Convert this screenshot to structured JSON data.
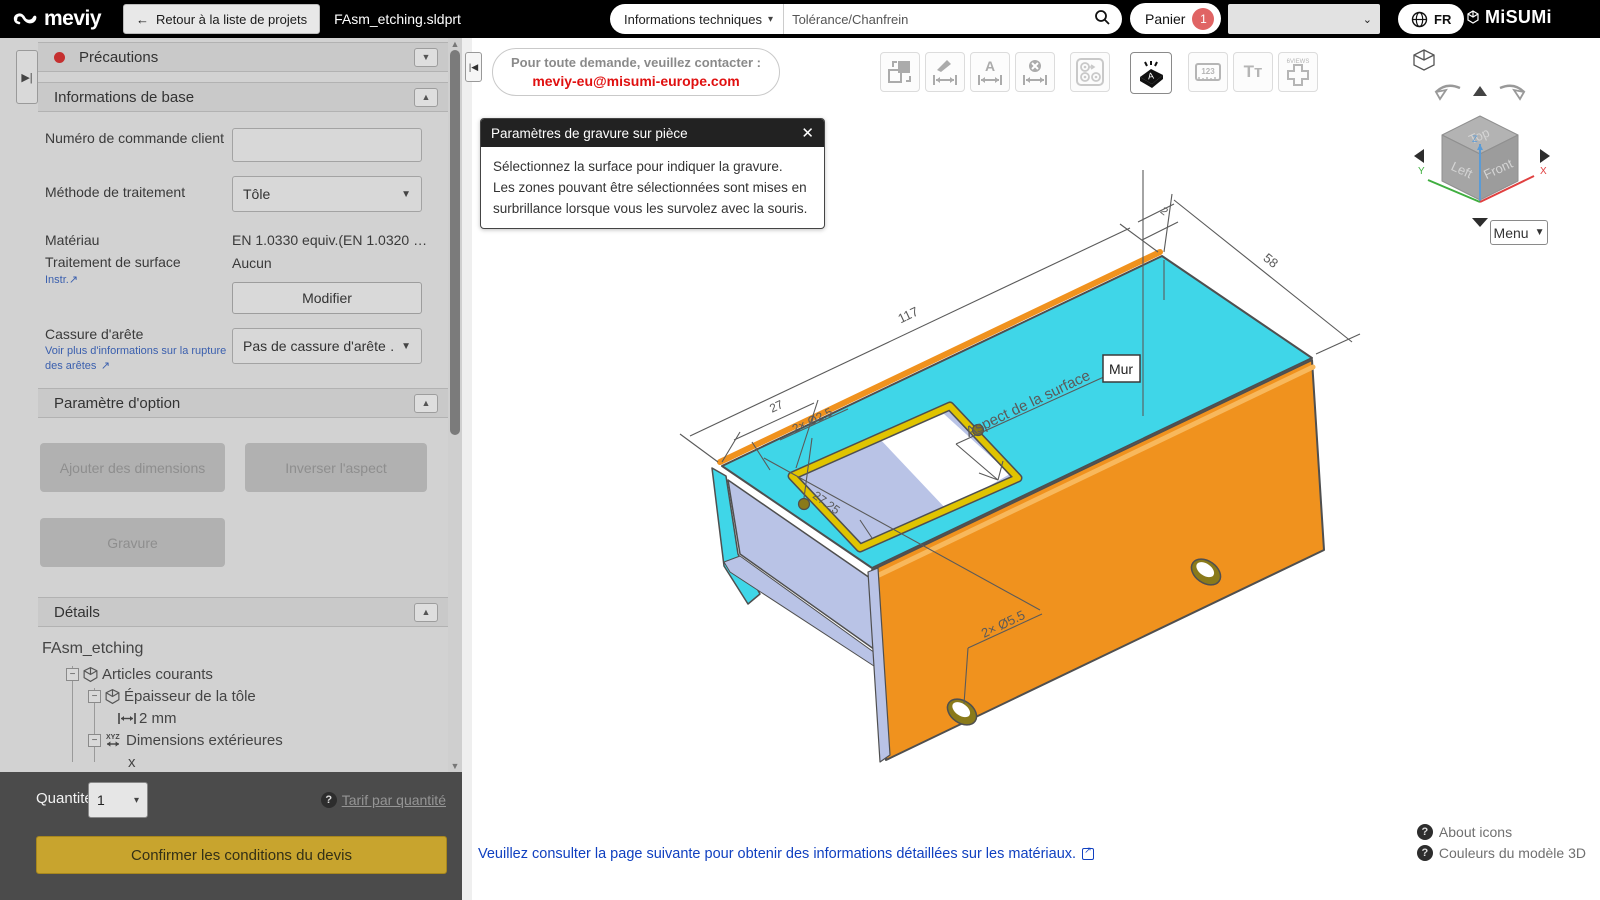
{
  "topbar": {
    "logo": "meviy",
    "back_button": "Retour à la liste de projets",
    "file_title": "FAsm_etching.sldprt",
    "info_dropdown": "Informations techniques",
    "search_value": "Tolérance/Chanfrein",
    "cart_label": "Panier",
    "cart_count": "1",
    "lang": "FR",
    "brand": "MiSUMi"
  },
  "sidebar": {
    "precautions_title": "Précautions",
    "basic_info": {
      "title": "Informations de base",
      "order_number_label": "Numéro de commande client",
      "treatment_method_label": "Méthode de traitement",
      "treatment_method_value": "Tôle",
      "material_label": "Matériau",
      "material_value": "EN 1.0330 equiv.(EN 1.0320 …",
      "surface_label": "Traitement de surface",
      "surface_value": "Aucun",
      "instr_link": "Instr.",
      "modify_button": "Modifier",
      "edge_break_label": "Cassure d'arête",
      "edge_break_link": "Voir plus d'informations sur la rupture des arêtes",
      "edge_break_value": "Pas de cassure d'arête …"
    },
    "option_params": {
      "title": "Paramètre d'option",
      "add_dimensions": "Ajouter des dimensions",
      "invert_aspect": "Inverser l'aspect",
      "engraving": "Gravure"
    },
    "details": {
      "title": "Détails",
      "root": "FAsm_etching",
      "items": [
        {
          "label": "Articles courants",
          "icon": "cube-icon"
        },
        {
          "label": "Épaisseur de la tôle",
          "icon": "cube-icon"
        },
        {
          "label": "2 mm",
          "icon": "width-dimension-icon"
        },
        {
          "label": "Dimensions extérieures",
          "icon": "xyz-dimension-icon"
        },
        {
          "label": "x",
          "icon": "none"
        }
      ]
    },
    "footer": {
      "quantity_label": "Quantité",
      "quantity_value": "1",
      "tariff_link": "Tarif par quantité",
      "confirm_button": "Confirmer les conditions du devis"
    }
  },
  "main": {
    "contact": {
      "line1": "Pour toute demande, veuillez contacter :",
      "email": "meviy-eu@misumi-europe.com"
    },
    "dialog": {
      "title": "Paramètres de gravure sur pièce",
      "body": [
        "Sélectionnez la surface pour indiquer la gravure.",
        "Les zones pouvant être sélectionnées sont mises en",
        "surbrillance lorsque vous les survolez avec la souris."
      ]
    },
    "toolbar": {
      "six_views_label": "6VIEWS",
      "ruler_label": "123",
      "text_label": "Tт"
    },
    "viewcube": {
      "menu_label": "Menu",
      "face_top": "Top",
      "face_left": "Left",
      "face_front": "Front",
      "axis_x": "X",
      "axis_y": "Y",
      "axis_z": "Z"
    },
    "model": {
      "dim_length": "117",
      "dim_width": "58",
      "dim_thickness": "2",
      "dim_cutout_offset": "27",
      "dim_cutout_width": "27.25",
      "note_small_holes": "2× Ø2.5",
      "note_large_holes": "2× Ø5.5",
      "surface_note": "Aspect de la surface",
      "wall_label": "Mur",
      "colors": {
        "top_face": "#3fd6e8",
        "front_face": "#f0921e",
        "inner_face": "#b9c3e6",
        "highlight_edge": "#e0c400",
        "hole_rim": "#8a7a1a"
      }
    },
    "footer_link": "Veuillez consulter la page suivante pour obtenir des informations détaillées sur les matériaux.",
    "about_icons": "About icons",
    "colors_3d": "Couleurs du modèle 3D"
  }
}
